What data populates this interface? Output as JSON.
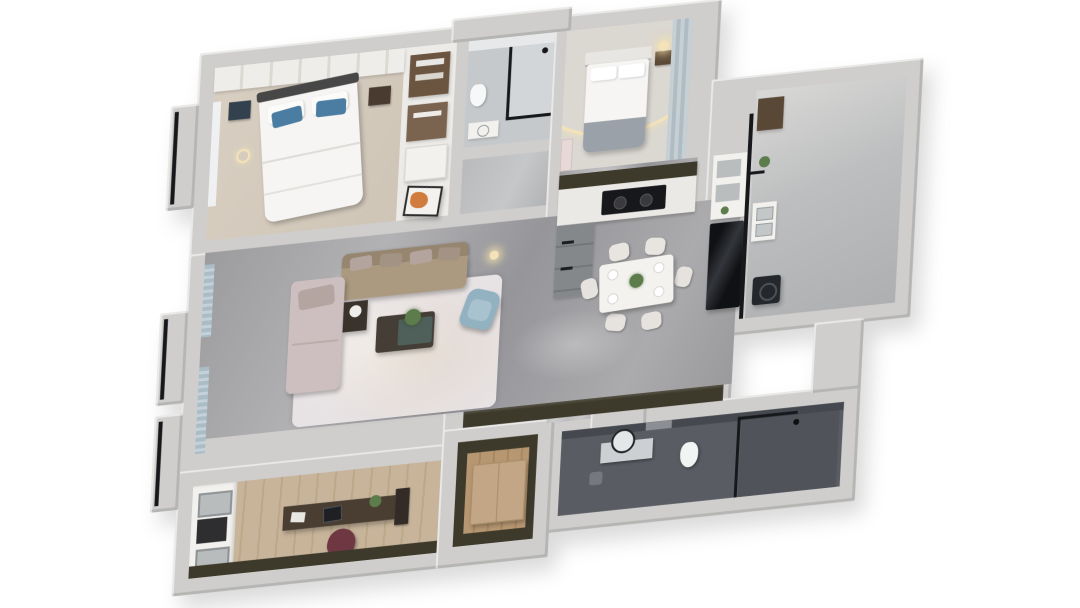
{
  "meta": {
    "view": "3d-isometric-floor-plan-render",
    "style": "photoreal dollhouse top-down apartment render on white background"
  },
  "palette": {
    "bg": "#ffffff",
    "wall": "#cfcecc",
    "wallShade": "#b5b4b2",
    "beige": "#d8cfc2",
    "floorLight": "#dbd7d1",
    "bathLight": "#c6c9cb",
    "bathDark": "#595d63",
    "bathWall": "#45494f",
    "wood": "#c7b49b",
    "entryWood": "#b69772",
    "olive": "#3e3a2b",
    "white": "#f2f1ee",
    "sofa": "#ab9a80",
    "sofaBack": "#97866f",
    "chaise": "#cdbfc0",
    "pillowBlue": "#4a7da1",
    "armchair": "#92b1c1",
    "curtain": "#aabdc7",
    "tableDark": "#453e36",
    "teal": "#4f5f59",
    "plant": "#5d7c4b",
    "maroon": "#6e3742",
    "darkWood": "#5a4836",
    "tan": "#c2a685",
    "black": "#17181b",
    "counter": "#eae9e5",
    "cabGray": "#85888b",
    "warm": "#f4e3b8",
    "rug": "#e7e2e4",
    "blanket": "#9aa1a9",
    "orange": "#d07c3c"
  },
  "rooms": [
    {
      "id": "master-bedroom",
      "area": "top-left",
      "furniture": [
        "wardrobe",
        "double-bed",
        "blue-pillows",
        "nightstand-left",
        "nightstand-right",
        "pendant-lamp",
        "bay-window"
      ]
    },
    {
      "id": "closet-column",
      "area": "top-center-left",
      "furniture": [
        "wood-shelves",
        "drawer-unit",
        "orange-artwork"
      ]
    },
    {
      "id": "bathroom-main",
      "area": "top-center",
      "furniture": [
        "glass-shower",
        "shower-head",
        "vanity",
        "toilet"
      ]
    },
    {
      "id": "bedroom-two",
      "area": "top-right",
      "furniture": [
        "bed",
        "headboard",
        "gray-blanket",
        "nightstand",
        "glowing-lamp",
        "wardrobe-panels",
        "led-arc-light"
      ]
    },
    {
      "id": "kitchen",
      "area": "right-center",
      "furniture": [
        "upper-cabinets",
        "counter",
        "black-cooktop",
        "base-cabinets"
      ]
    },
    {
      "id": "dining-area",
      "area": "center-right",
      "furniture": [
        "dining-table",
        "dining-chairs-x6",
        "plates",
        "centerpiece-plant",
        "shelf-unit",
        "tall-black-cabinet"
      ]
    },
    {
      "id": "balcony",
      "area": "far-right",
      "furniture": [
        "glazed-wall",
        "utility-cabinet",
        "washing-machine",
        "wood-cabinet",
        "plant"
      ]
    },
    {
      "id": "bathroom-guest",
      "area": "bottom-right",
      "furniture": [
        "vanity",
        "round-mirror",
        "stool",
        "toilet",
        "glass-shower",
        "shower-head"
      ]
    },
    {
      "id": "living-room",
      "area": "center-left",
      "furniture": [
        "l-shaped-sofa",
        "chaise-lounge",
        "back-cushions",
        "side-table",
        "coffee-table",
        "plant",
        "blue-armchair",
        "area-rug",
        "curtains",
        "tv-band",
        "floor-lamp"
      ]
    },
    {
      "id": "study",
      "area": "bottom-left",
      "furniture": [
        "built-in-shelves",
        "desk",
        "laptop",
        "book-rack",
        "office-chair",
        "accent-wall"
      ]
    },
    {
      "id": "entry-hall",
      "area": "bottom-center",
      "furniture": [
        "shoe-cabinet",
        "olive-walls"
      ]
    }
  ]
}
